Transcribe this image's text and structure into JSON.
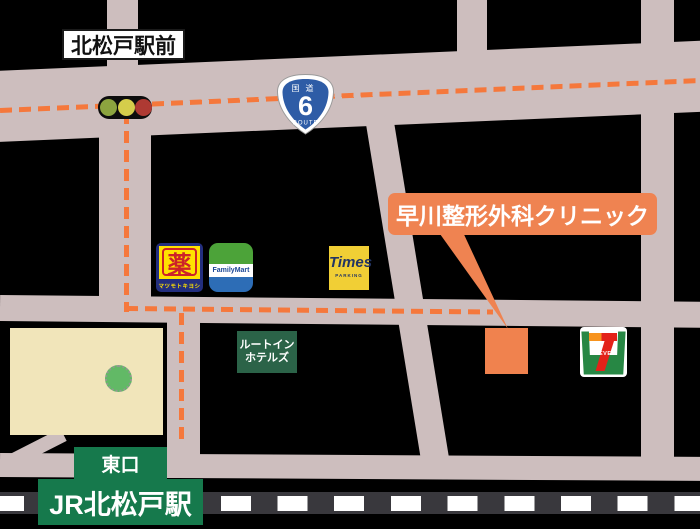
{
  "intersection_label": "北松戸駅前",
  "route_shield": {
    "top": "国道",
    "number": "6",
    "bottom": "ROUTE"
  },
  "clinic": {
    "label": "早川整形外科クリニック"
  },
  "station": {
    "exit": "東口",
    "name": "JR北松戸駅"
  },
  "pois": {
    "matsukiyo": {
      "symbol": "薬",
      "caption": "マツモトキヨシ"
    },
    "familymart": {
      "label": "FamilyMart"
    },
    "times": {
      "label": "Times",
      "caption": "PARKING"
    },
    "route_inn": {
      "line1": "ルートイン",
      "line2": "ホテルズ"
    },
    "seven_eleven": {
      "label": "ELEVEN"
    }
  },
  "colors": {
    "background": "#000000",
    "road": "#CDBEBE",
    "route_dash": "#F5783C",
    "clinic_orange": "#EF8351",
    "plaza_beige": "#F1E5BA",
    "station_green": "#16794C",
    "railway_dark": "#39383D",
    "route_shield_blue": "#2E5CA6",
    "traffic_green": "#8CA43F",
    "traffic_yellow": "#D5CD4B",
    "traffic_red": "#AE3A33"
  }
}
